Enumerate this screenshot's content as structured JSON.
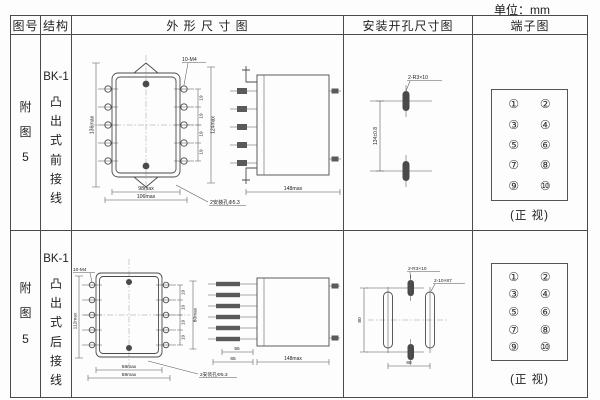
{
  "unit_label": "单位：mm",
  "table": {
    "headers": {
      "fig_no": "图号",
      "structure": "结构",
      "outline": "外 形 尺 寸 图",
      "mounting": "安装开孔尺寸图",
      "terminal": "端子图"
    },
    "rows": [
      {
        "fig_no": "附图5",
        "model": "BK-1",
        "structure": "凸出式前接线",
        "outline": {
          "front": {
            "height": "136max",
            "screw": "10-M4",
            "pitch": "19",
            "right_height": "124max",
            "width_inner": "98max",
            "width_outer": "106max",
            "holes": "2安装孔Φ5.3"
          },
          "side": {
            "depth": "148max"
          }
        },
        "mounting": {
          "slots": "2-R3×10",
          "span": "134±0.8"
        },
        "terminal": {
          "pins": [
            "①",
            "②",
            "③",
            "④",
            "⑤",
            "⑥",
            "⑦",
            "⑧",
            "⑨",
            "⑩"
          ],
          "view": "(正 视)"
        }
      },
      {
        "fig_no": "附图5",
        "model": "BK-1",
        "structure": "凸出式后接线",
        "outline": {
          "front": {
            "screw": "10-M4",
            "height": "112max",
            "pitch": "19",
            "right_height": "80max",
            "width_inner": "68max",
            "width_outer": "88max",
            "holes": "2安装孔Φ5.3"
          },
          "side": {
            "dim_a": "55",
            "dim_b": "65",
            "depth": "148max"
          }
        },
        "mounting": {
          "slots_small": "2-R3×10",
          "slots_long": "2-10×87",
          "height": "80",
          "width": "68"
        },
        "terminal": {
          "pins": [
            "①",
            "②",
            "③",
            "④",
            "⑤",
            "⑥",
            "⑦",
            "⑧",
            "⑨",
            "⑩"
          ],
          "view": "(正 视)"
        }
      }
    ]
  }
}
